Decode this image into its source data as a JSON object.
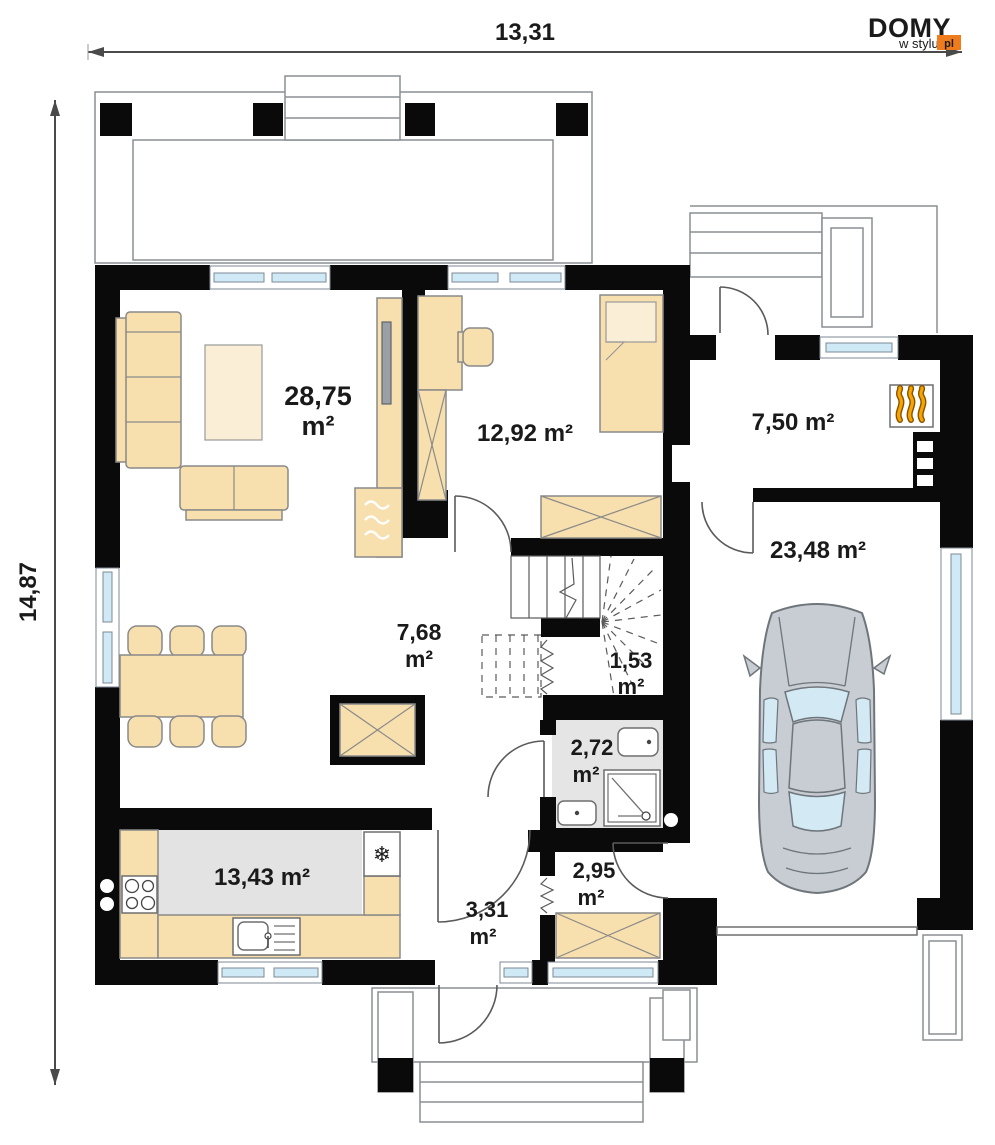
{
  "dimensions": {
    "top": "13,31",
    "left": "14,87"
  },
  "logo": {
    "brand": "DOMY",
    "tagline": "w stylu",
    "tld": "pl",
    "accent_color": "#ee7b1c"
  },
  "rooms": {
    "living": {
      "area": "28,75",
      "unit": "m²"
    },
    "bedroom": {
      "label": "12,92 m²"
    },
    "entry": {
      "label": "7,50 m²"
    },
    "garage": {
      "label": "23,48 m²"
    },
    "hall": {
      "area": "7,68",
      "unit": "m²"
    },
    "understairs": {
      "area": "1,53",
      "unit": "m²"
    },
    "bathroom": {
      "area": "2,72",
      "unit": "m²"
    },
    "kitchen": {
      "label": "13,43 m²"
    },
    "vestibule": {
      "area": "3,31",
      "unit": "m²"
    },
    "utility": {
      "area": "2,95",
      "unit": "m²"
    }
  },
  "icons": {
    "fridge": "❄",
    "heater": "flames",
    "radiator": "waves",
    "car": "car-top-view"
  },
  "colors": {
    "wall": "#0a0a0a",
    "furniture": "#f7dfae",
    "window_glass": "#cfe9f7",
    "floor_gray": "#e3e3e3",
    "flame_orange": "#f6a500",
    "car_body": "#c7cdd2"
  }
}
